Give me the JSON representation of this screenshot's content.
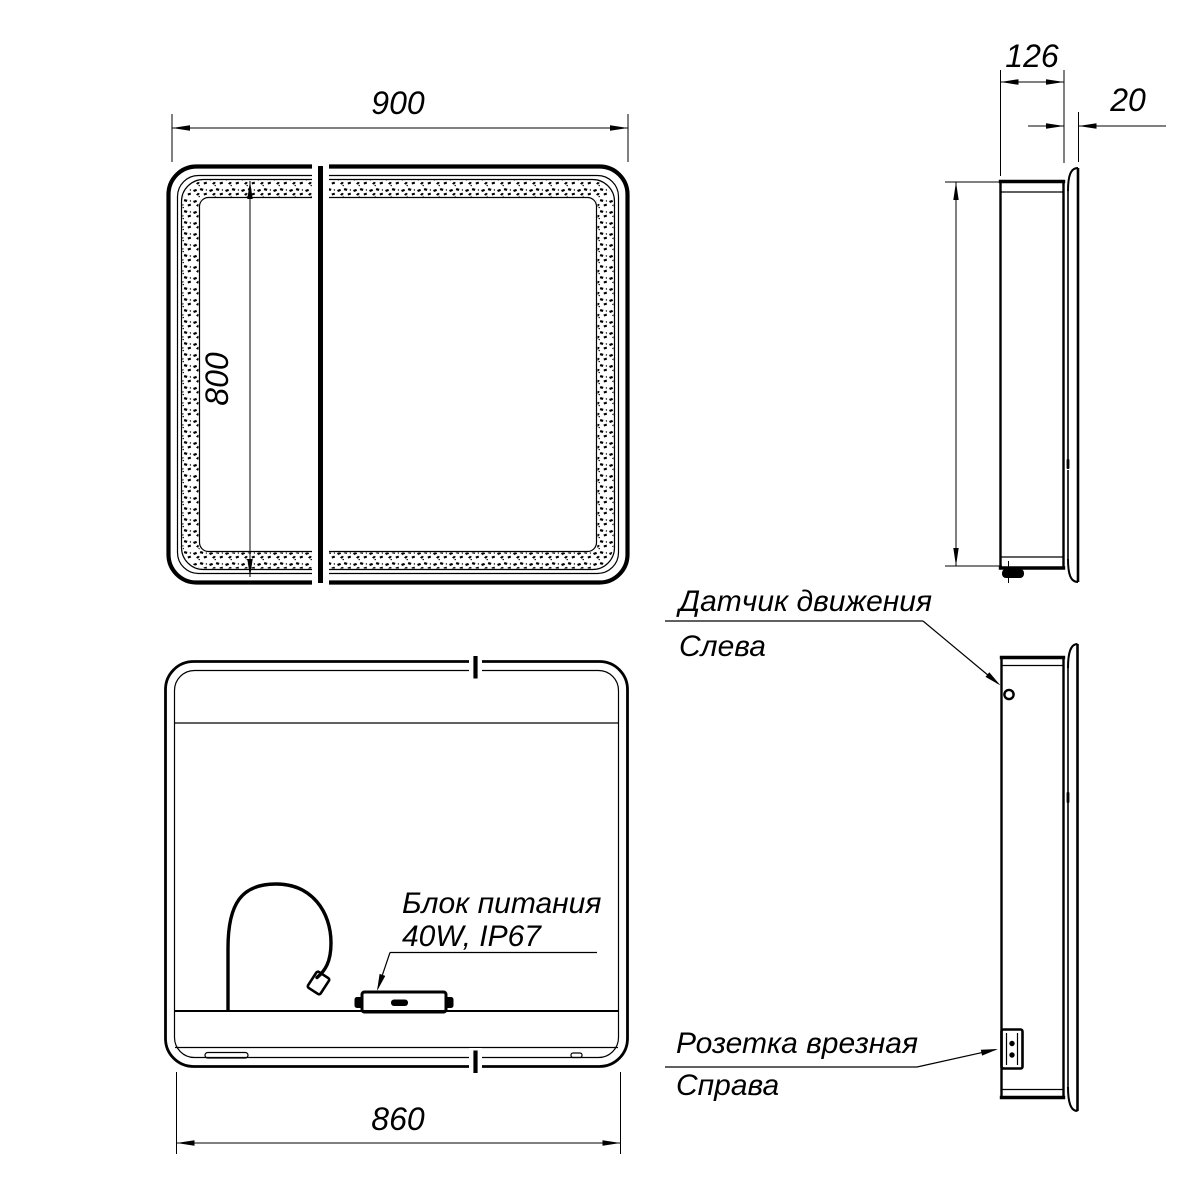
{
  "views": {
    "front": {
      "width_dim": "900",
      "height_dim": "800"
    },
    "side_top": {
      "depth_dim": "126",
      "mirror_dim": "20"
    },
    "back": {
      "width_dim": "860",
      "psu_label_1": "Блок питания",
      "psu_label_2": "40W, IP67"
    },
    "side_bottom": {
      "sensor_label_1": "Датчик движения",
      "sensor_label_2": "Слева",
      "socket_label_1": "Розетка врезная",
      "socket_label_2": "Справа"
    }
  },
  "colors": {
    "line": "#000000",
    "background": "#ffffff"
  }
}
